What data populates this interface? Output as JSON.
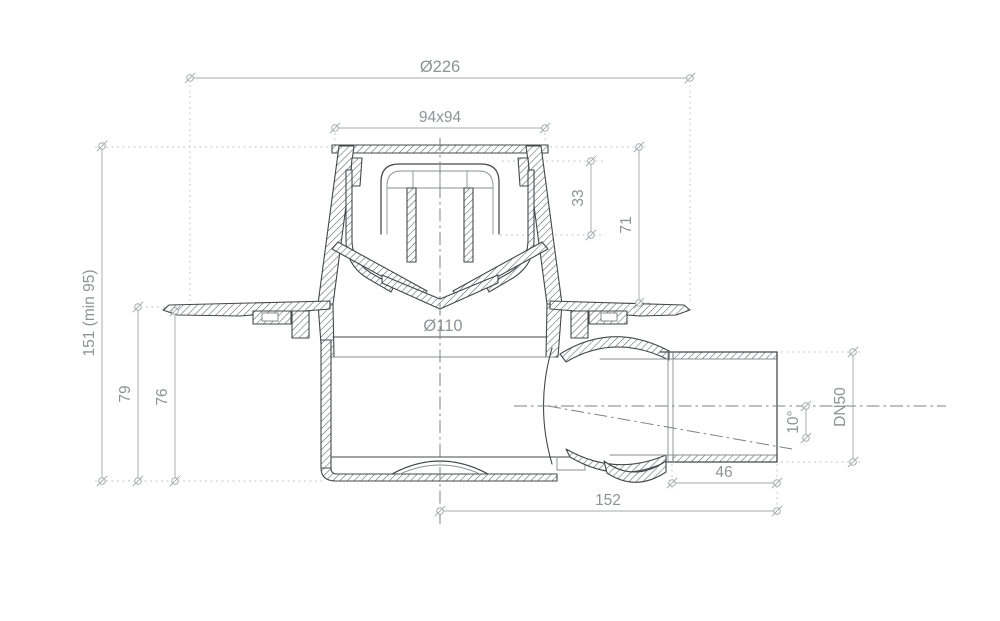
{
  "drawing": {
    "labels": {
      "outer_diameter": "Ø226",
      "grate_size": "94x94",
      "insert_depth": "33",
      "upper_height": "71",
      "total_height": "151 (min 95)",
      "flange_to_bottom": "79",
      "membrane_to_bottom": "76",
      "body_diameter": "Ø110",
      "outlet_diameter": "DN50",
      "outlet_angle": "10°",
      "socket_length": "46",
      "outlet_offset": "152"
    },
    "style": {
      "line_color": "#45484a",
      "dimension_color": "#a6aaac",
      "text_color": "#8f9396",
      "background": "#ffffff"
    }
  }
}
